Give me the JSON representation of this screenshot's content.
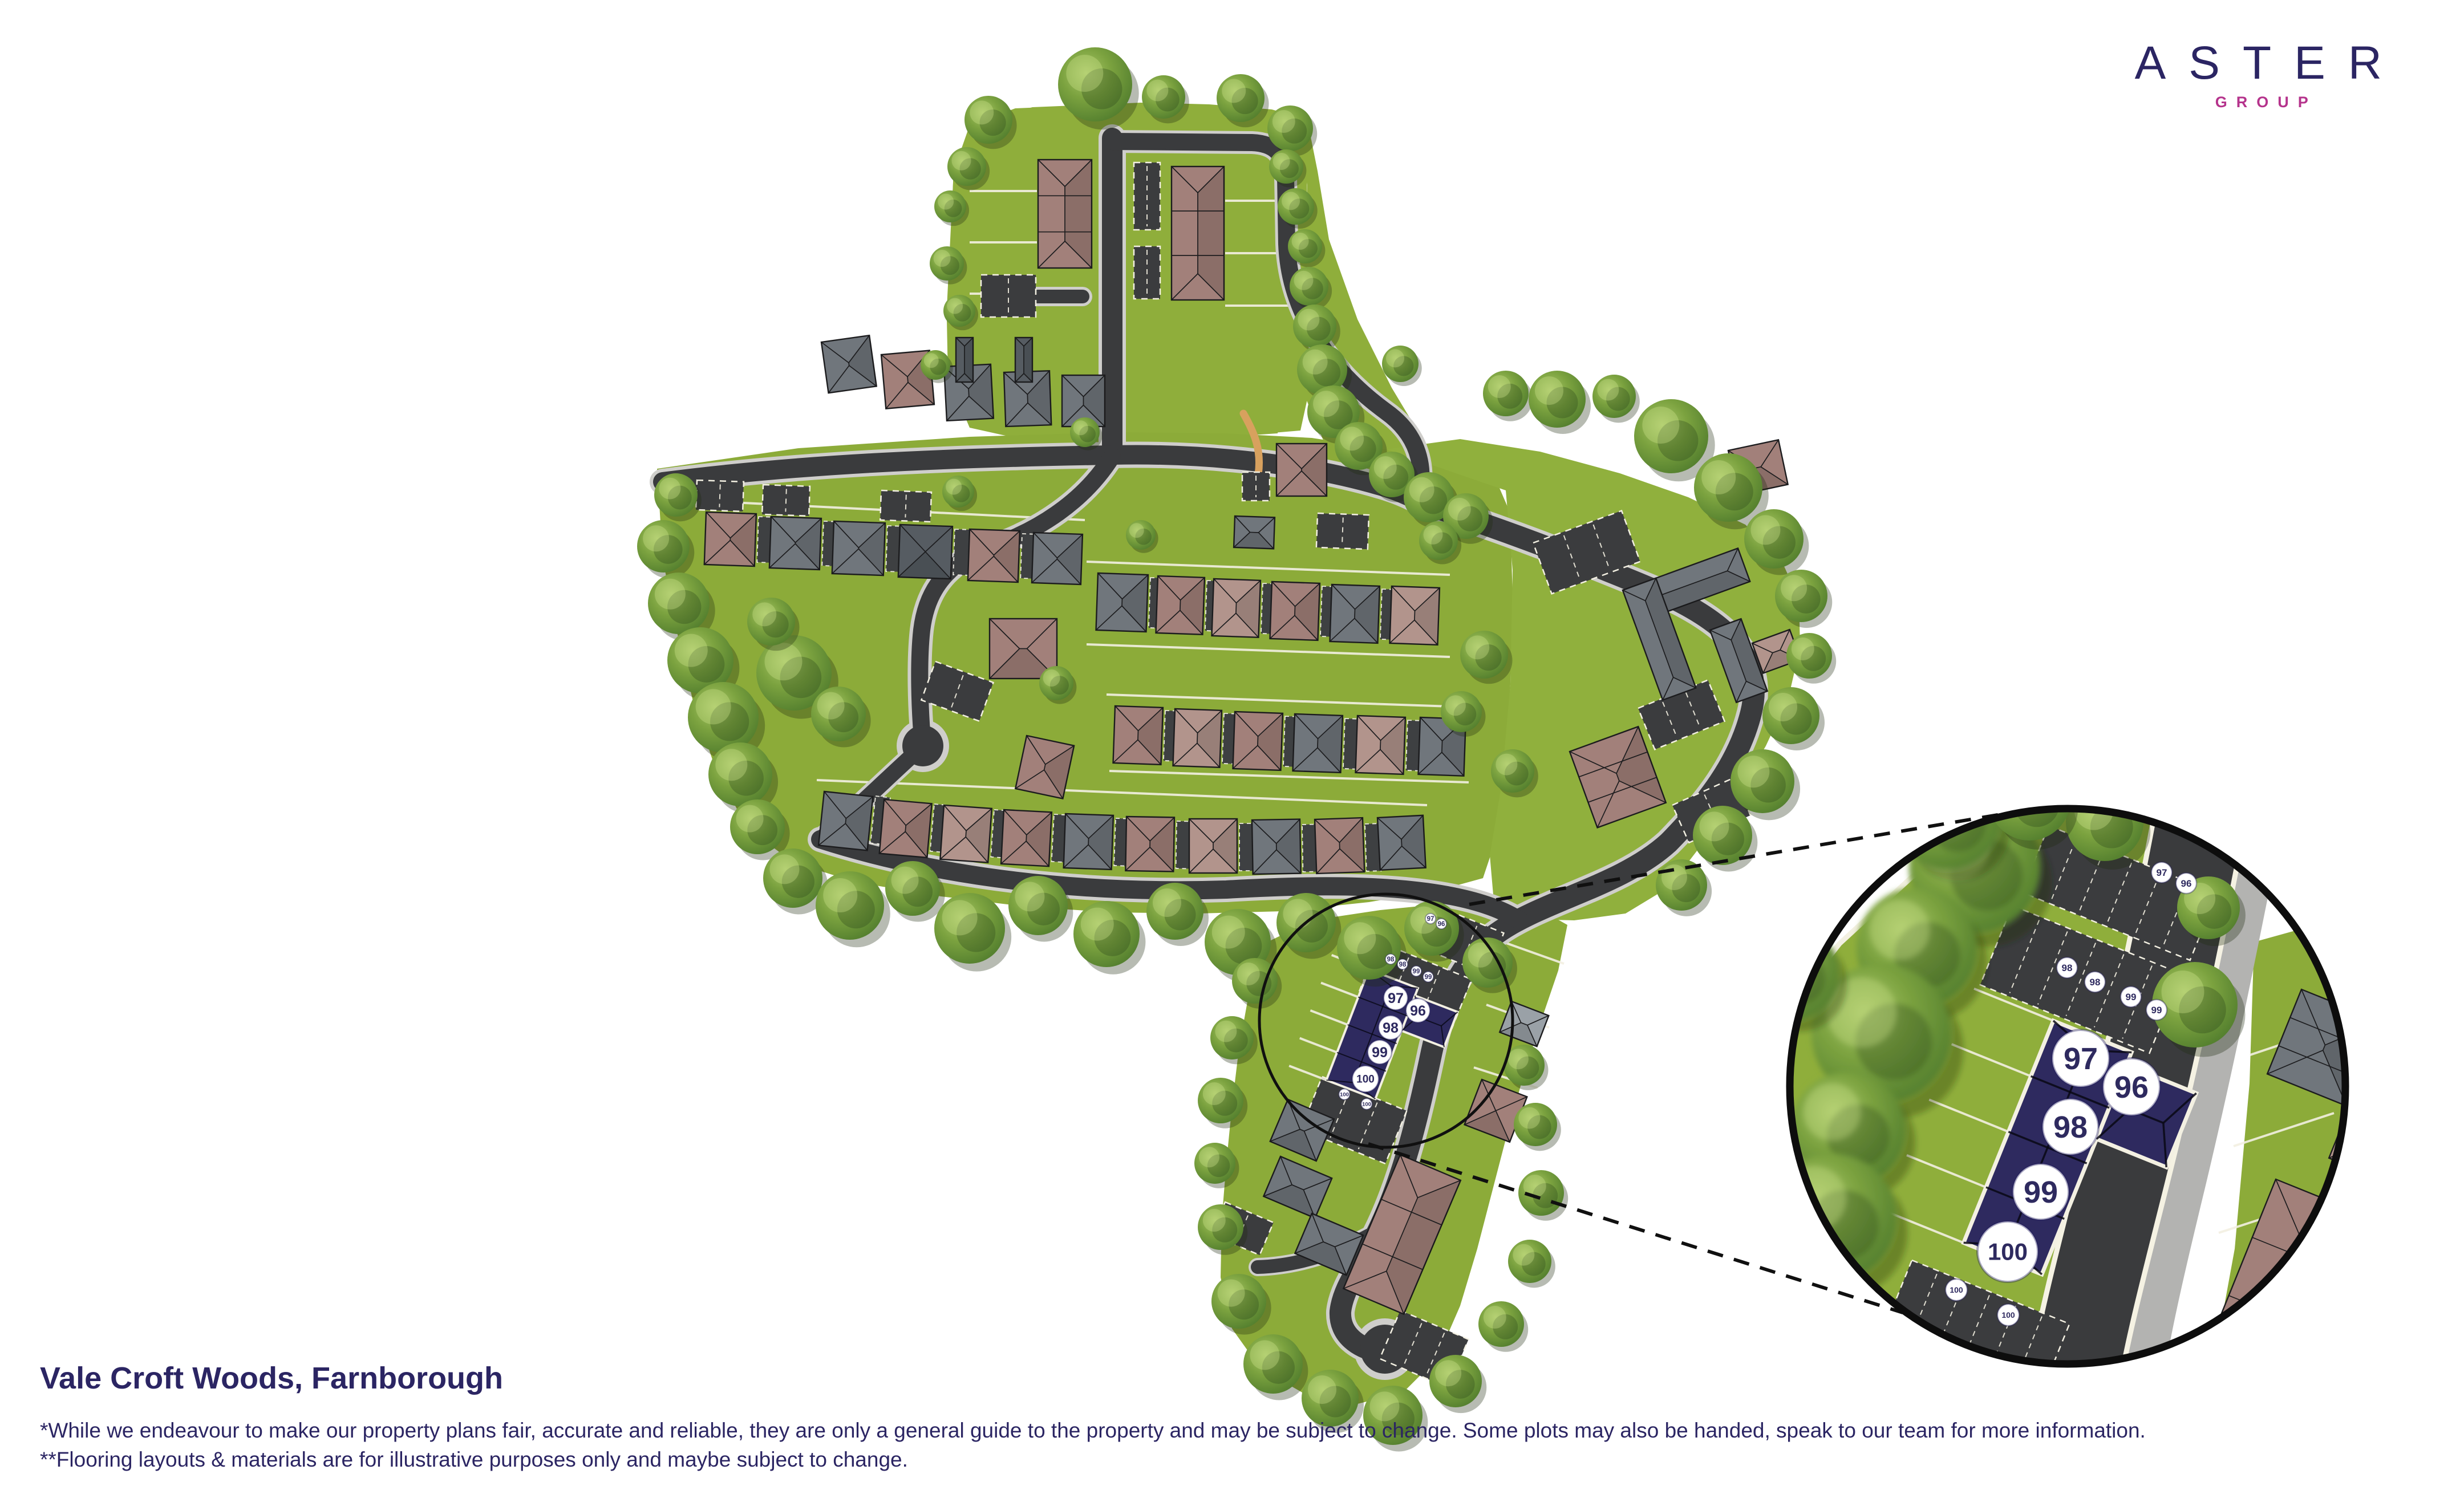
{
  "brand": {
    "name": "ASTER",
    "division": "GROUP"
  },
  "development": {
    "title": "Vale Croft Woods, Farnborough"
  },
  "disclaimers": {
    "line1": "*While we endeavour to make our property plans fair, accurate and reliable, they are only a general guide to the property and may be subject to change. Some plots may also be handed, speak to our team for more information.",
    "line2": "**Flooring layouts & materials are for illustrative purposes only and maybe subject to change."
  },
  "plots": {
    "highlighted_main": [
      "97",
      "96",
      "98",
      "99",
      "100"
    ],
    "parking_main": [
      "97",
      "96",
      "98",
      "98",
      "99",
      "99",
      "100",
      "100"
    ],
    "highlighted_inset": [
      "97",
      "96",
      "98",
      "99",
      "100"
    ],
    "parking_inset": [
      "97",
      "96",
      "98",
      "98",
      "99",
      "99",
      "100",
      "100"
    ]
  },
  "colors": {
    "brand_navy": "#2b2563",
    "brand_magenta": "#b5338c",
    "plot_highlight_navy": "#2e2a5f",
    "grass_green": "#8cab39",
    "road_dark": "#3a3b3d",
    "sidewalk_grey": "#cfcecb",
    "tree_green": "#6e9a40"
  }
}
